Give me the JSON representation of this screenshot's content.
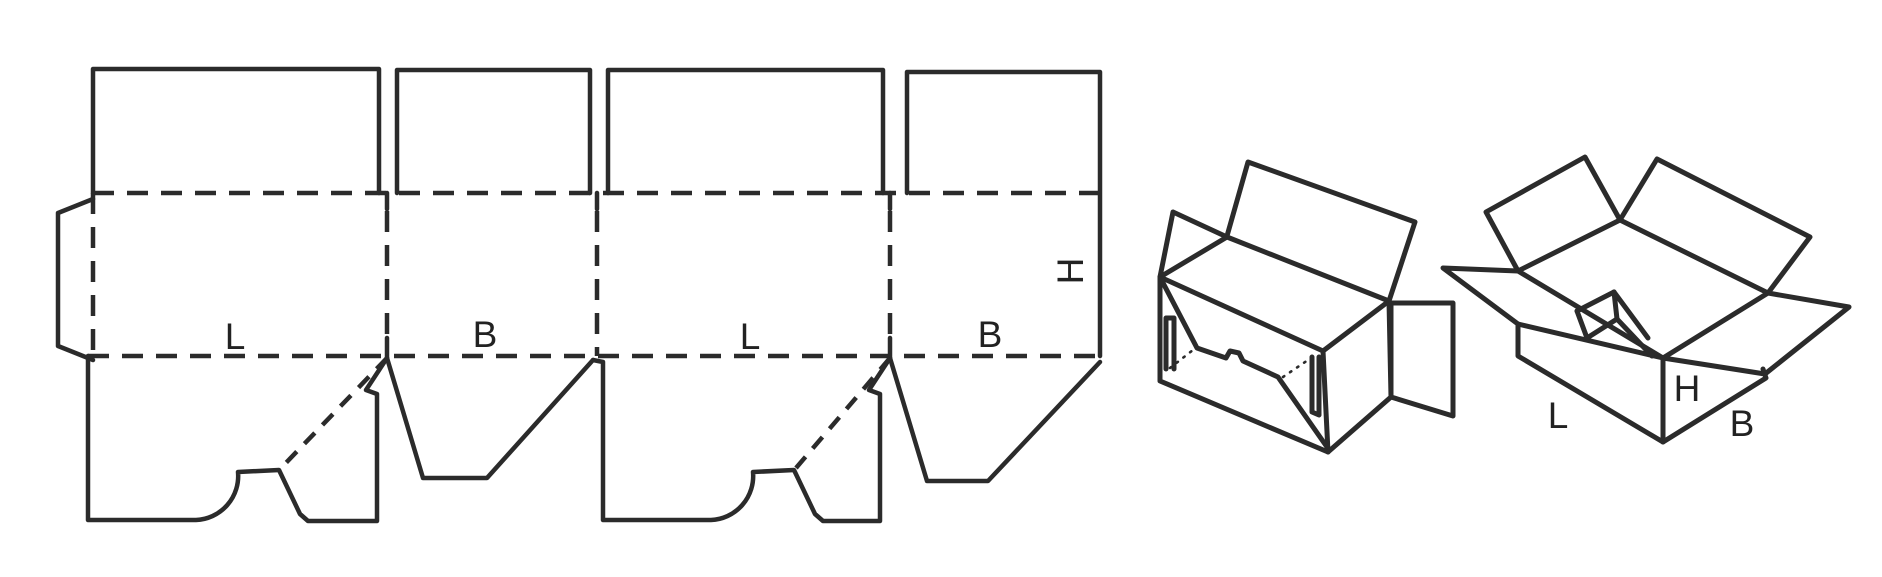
{
  "colors": {
    "background": "#ffffff",
    "line": "#2b2b2b",
    "text": "#222222"
  },
  "dieline": {
    "panel_labels": [
      "L",
      "B",
      "L",
      "B"
    ],
    "height_label": "H"
  },
  "open_box_view": {
    "length_label": "L",
    "height_label": "H",
    "breadth_label": "B"
  }
}
